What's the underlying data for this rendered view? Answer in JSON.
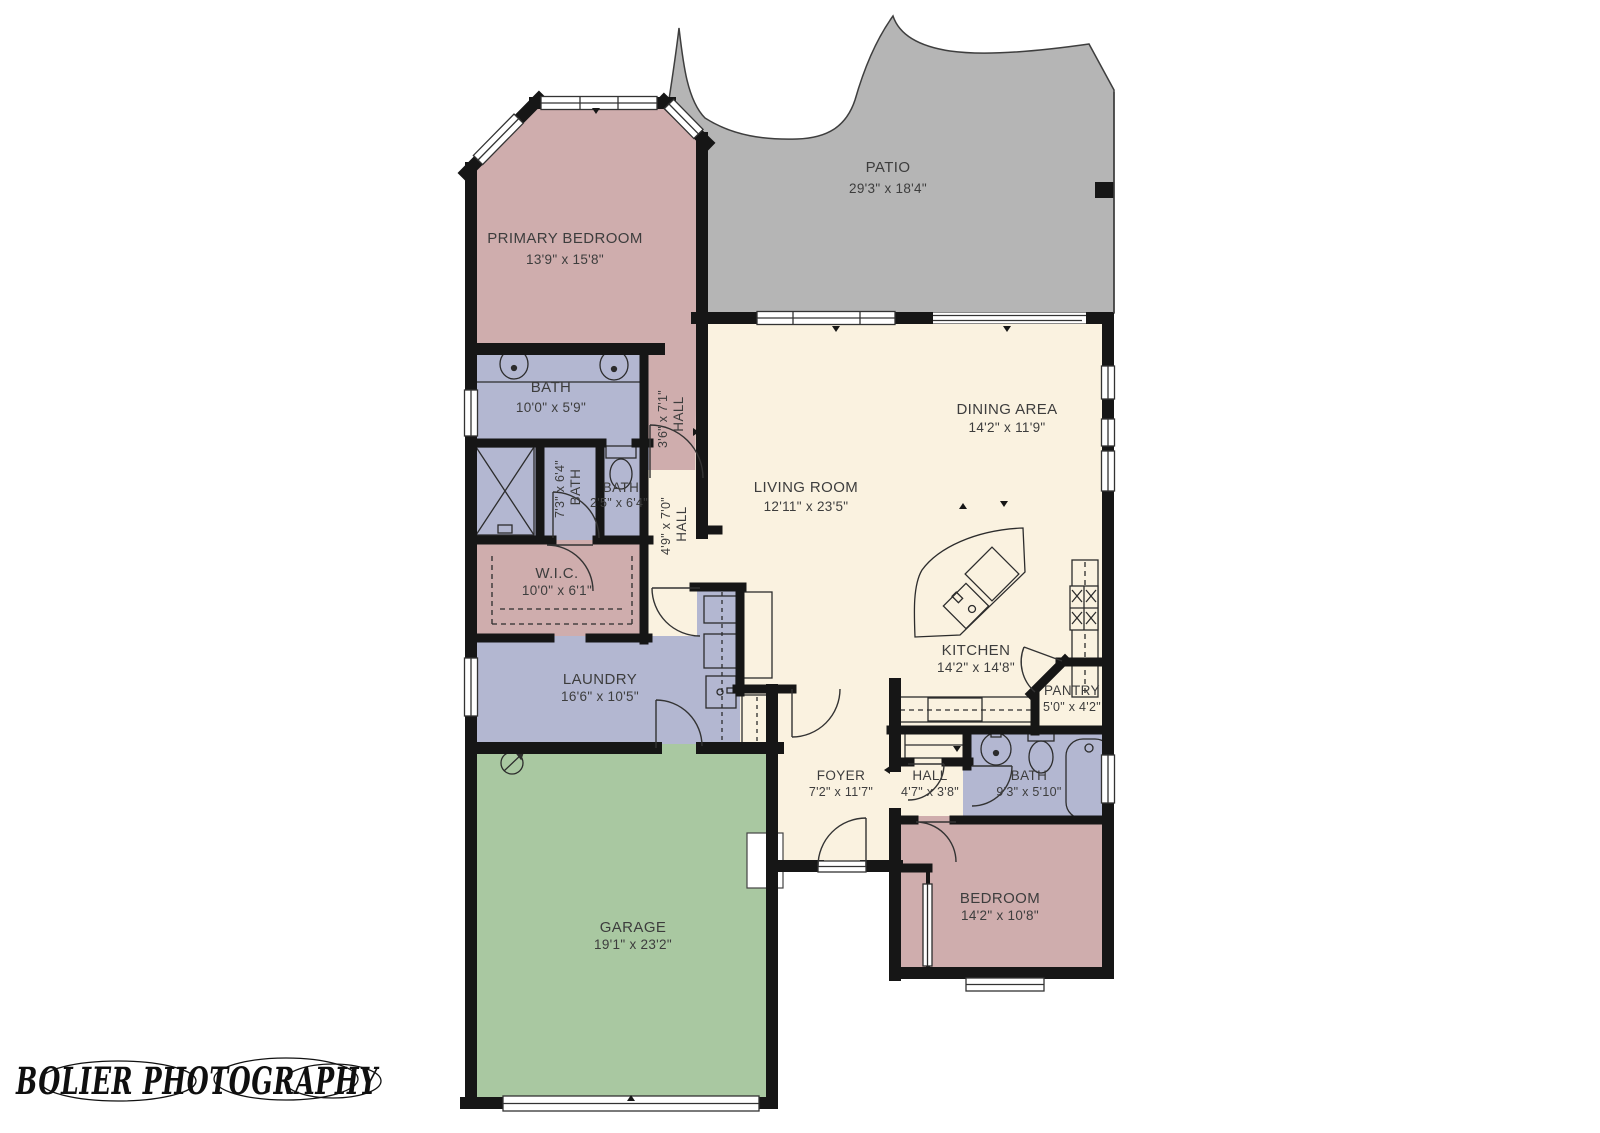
{
  "watermark": "BOLIER PHOTOGRAPHY",
  "colors": {
    "wall": "#161616",
    "patio": "#b5b5b5",
    "bedroom_rose": "#cfadad",
    "bath_lavender": "#b3b7d1",
    "living_cream": "#faf2e0",
    "garage_green": "#a9c8a1",
    "label_text": "#3d3d3d"
  },
  "rooms": {
    "patio": {
      "name": "PATIO",
      "dims": "29'3\" x 18'4\""
    },
    "primary_bedroom": {
      "name": "PRIMARY BEDROOM",
      "dims": "13'9\" x 15'8\""
    },
    "bath_primary": {
      "name": "BATH",
      "dims": "10'0\" x 5'9\""
    },
    "hall_primary": {
      "name": "HALL",
      "dims": "3'6\" x 7'1\""
    },
    "bath_mid": {
      "name": "BATH",
      "dims": "7'3\" x 6'4\""
    },
    "bath_toilet": {
      "name": "BATH",
      "dims": "2'5\" x 6'4\""
    },
    "hall_mid": {
      "name": "HALL",
      "dims": "4'9\" x 7'0\""
    },
    "wic": {
      "name": "W.I.C.",
      "dims": "10'0\" x 6'1\""
    },
    "living_room": {
      "name": "LIVING ROOM",
      "dims": "12'11\" x 23'5\""
    },
    "dining_area": {
      "name": "DINING AREA",
      "dims": "14'2\" x 11'9\""
    },
    "kitchen": {
      "name": "KITCHEN",
      "dims": "14'2\" x 14'8\""
    },
    "pantry": {
      "name": "PANTRY",
      "dims": "5'0\" x 4'2\""
    },
    "laundry": {
      "name": "LAUNDRY",
      "dims": "16'6\" x 10'5\""
    },
    "foyer": {
      "name": "FOYER",
      "dims": "7'2\" x 11'7\""
    },
    "hall_east": {
      "name": "HALL",
      "dims": "4'7\" x 3'8\""
    },
    "bath_east": {
      "name": "BATH",
      "dims": "9'3\" x 5'10\""
    },
    "bedroom": {
      "name": "BEDROOM",
      "dims": "14'2\" x 10'8\""
    },
    "garage": {
      "name": "GARAGE",
      "dims": "19'1\" x 23'2\""
    }
  }
}
